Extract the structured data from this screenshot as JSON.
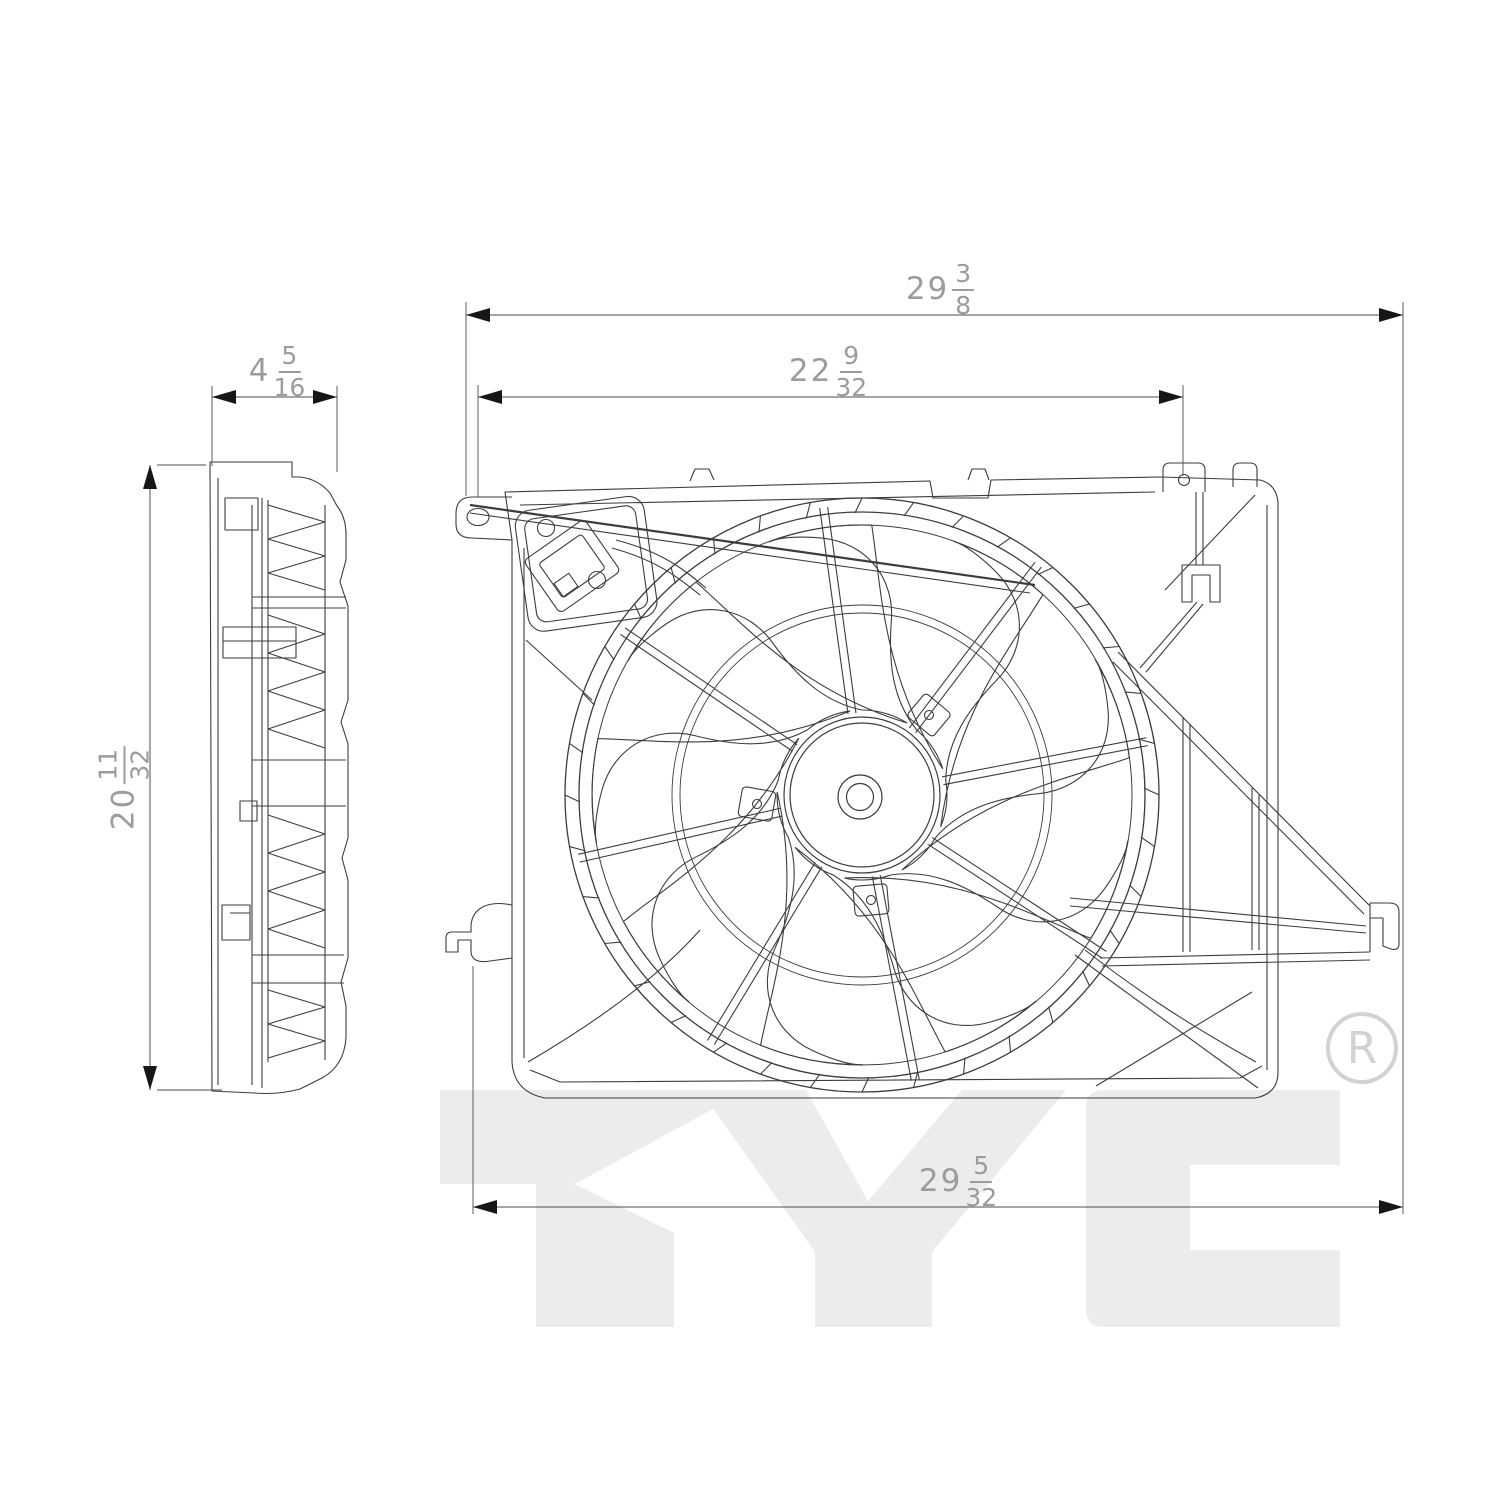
{
  "drawing": {
    "type": "engine-cooling-fan-assembly-technical-drawing",
    "watermark": {
      "text": "TYC",
      "registered": "R"
    },
    "dimensions": {
      "top_width": {
        "whole": "29",
        "numerator": "3",
        "denominator": "8"
      },
      "upper_inner_width": {
        "whole": "22",
        "numerator": "9",
        "denominator": "32"
      },
      "side_depth": {
        "whole": "4",
        "numerator": "5",
        "denominator": "16"
      },
      "left_height": {
        "whole": "20",
        "numerator": "11",
        "denominator": "32"
      },
      "bottom_width": {
        "whole": "29",
        "numerator": "5",
        "denominator": "32"
      }
    },
    "colors": {
      "background": "#ffffff",
      "line": "#3d3d3d",
      "dimension_line": "#4c4c4c",
      "arrow": "#161616",
      "dimension_text": "#9c9c9c",
      "watermark": "#ececec",
      "registered_mark": "#d2d2d2"
    }
  }
}
